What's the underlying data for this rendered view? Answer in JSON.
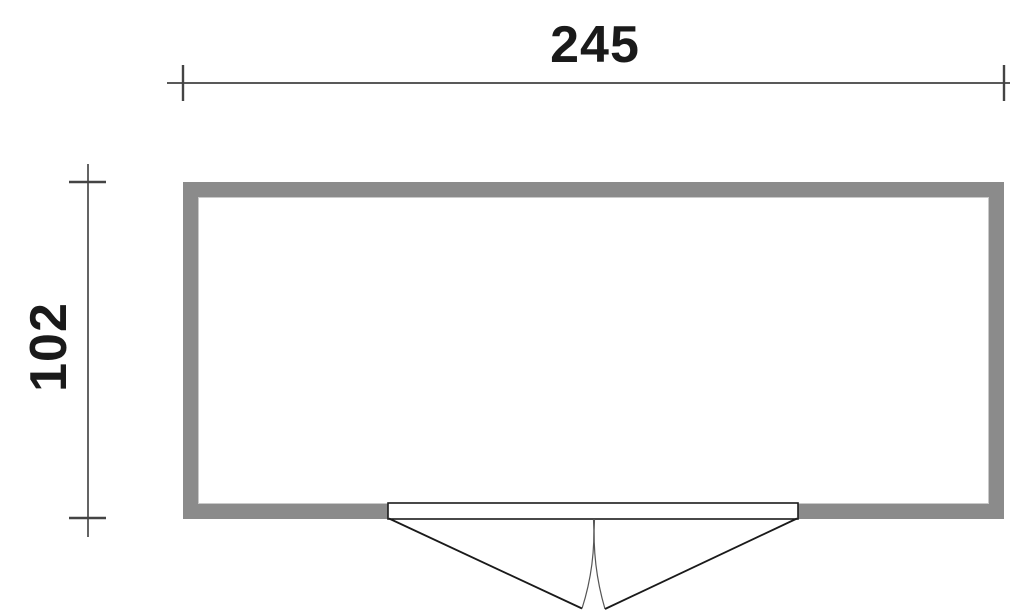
{
  "floor_plan": {
    "width_label": "245",
    "height_label": "102"
  },
  "colors": {
    "background": "#ffffff",
    "wall_fill": "#8b8b8b",
    "wall_inner_edge": "#c9c9c9",
    "dimension_line": "#222222",
    "dimension_tick": "#444444",
    "dimension_text": "#1a1a1a",
    "door_outline": "#1a1a1a",
    "door_fill": "#ffffff",
    "door_swing_arc": "#555555"
  }
}
